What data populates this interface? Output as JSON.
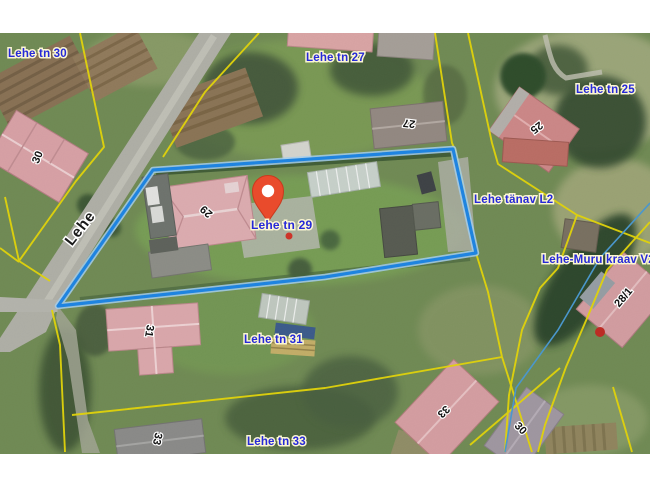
{
  "map": {
    "street_label": "Lehe",
    "pin": {
      "label": "Lehe tn 29",
      "color": "#e94b2c"
    },
    "parcel_labels": {
      "lehe_tn_30": "Lehe tn 30",
      "lehe_tn_27": "Lehe tn 27",
      "lehe_tn_25": "Lehe tn 25",
      "lehe_tanav_l2": "Lehe tänav L2",
      "lehe_muru_kraav_v2": "Lehe-Muru kraav V2",
      "lehe_tn_31": "Lehe tn 31",
      "lehe_tn_33": "Lehe tn 33"
    },
    "building_numbers": {
      "b30_nw": "30",
      "b27": "27",
      "b25": "25",
      "b29": "29",
      "b31": "31",
      "b33_sw": "33",
      "b33_se": "33",
      "b30_se": "30",
      "b28_1": "28/1"
    },
    "colors": {
      "selected_parcel_outline": "#1c87e8",
      "cadastral_line": "#e9da07",
      "label_blue": "#2629d8",
      "building_number_black": "#111111",
      "pin_red": "#e94b2c",
      "stream_blue": "#4a9bd4"
    }
  }
}
